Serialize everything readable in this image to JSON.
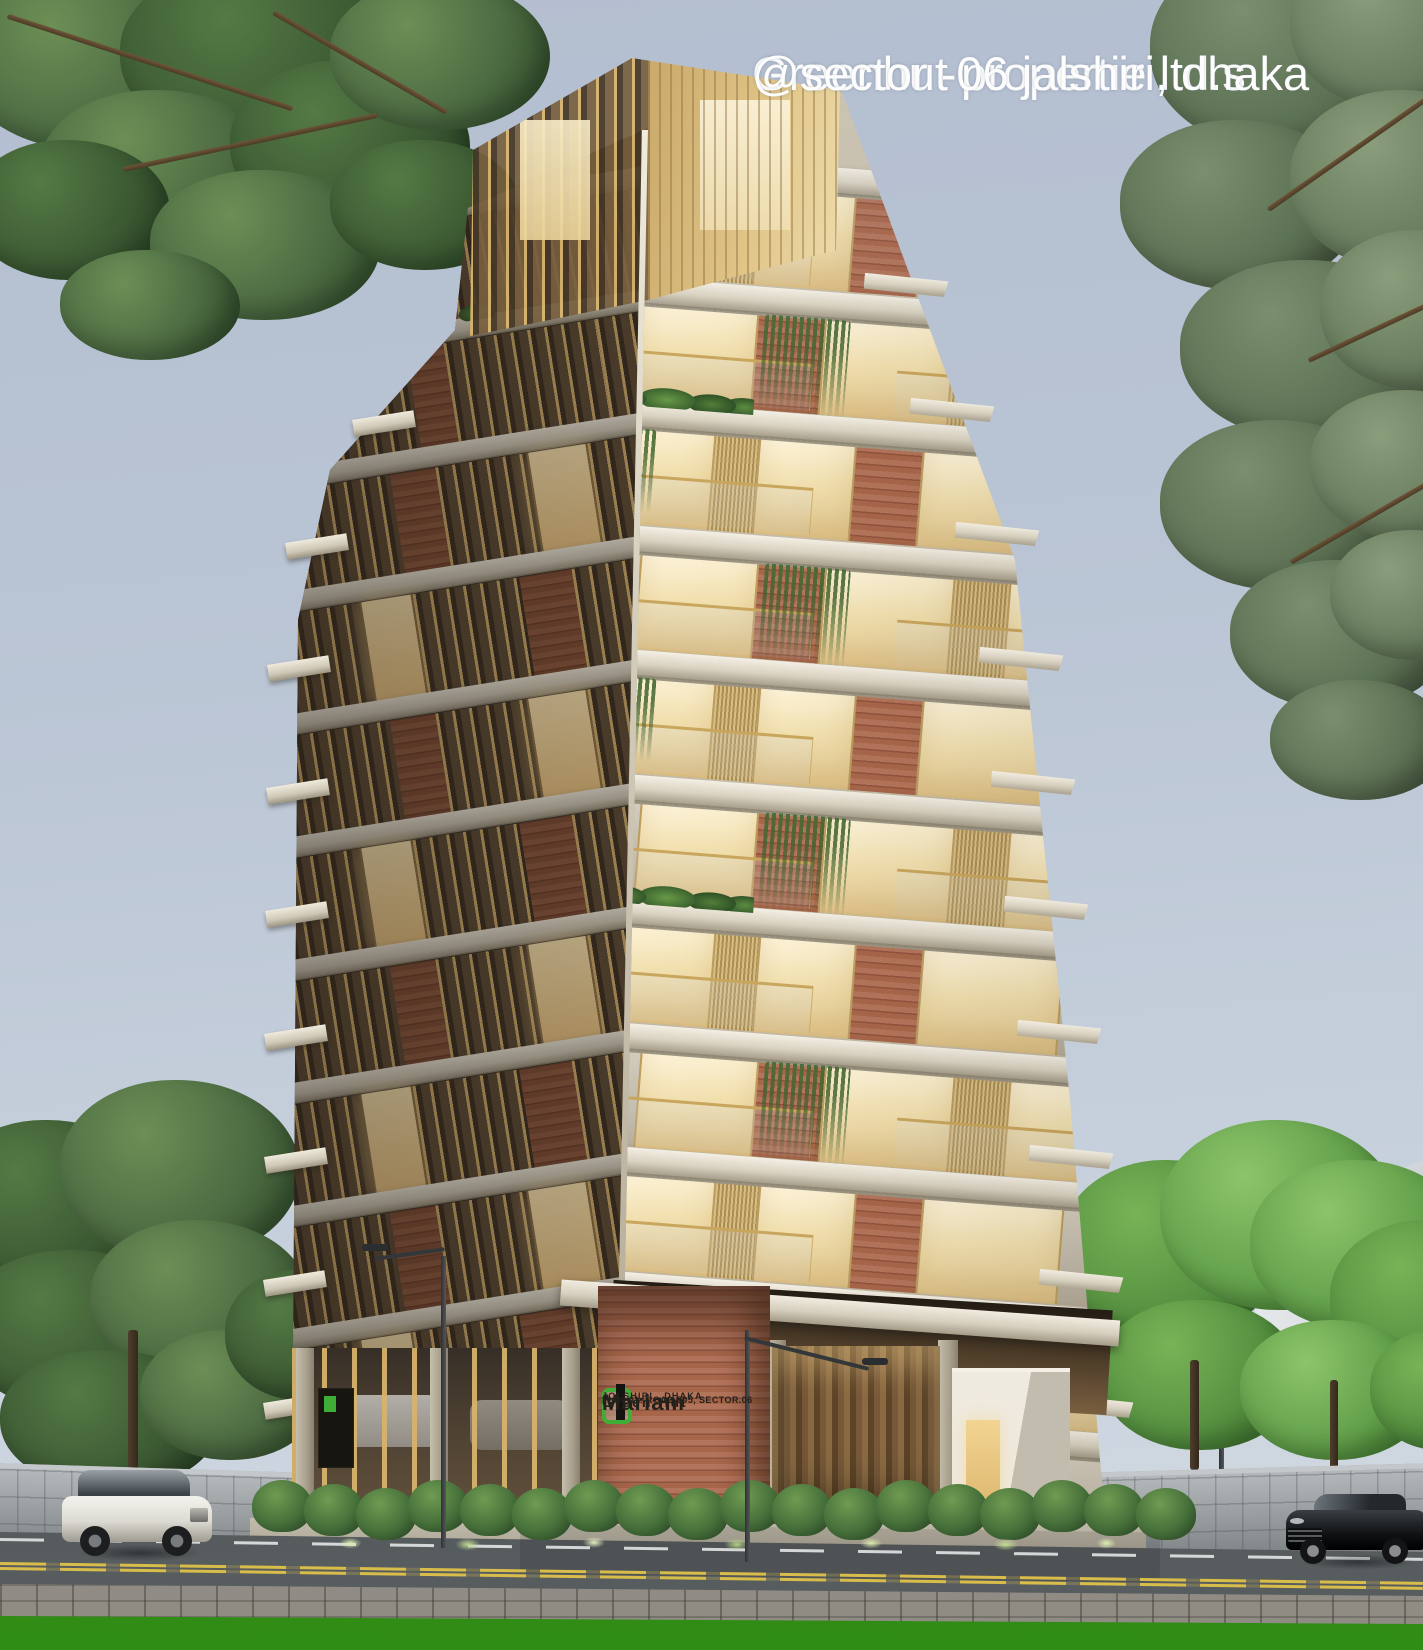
{
  "overlay": {
    "line1": "Greenhut propertie ltd.s",
    "line2": "@sector -06 jalshiri, dhaka"
  },
  "signage": {
    "logo_icon": "greenhut-logo",
    "brand_top": "Green Hut",
    "project_name": "Mariam",
    "address_line": "Plot# 01: ROAD.505, SECTOR.06",
    "city_line": "JOLSHIRI . DHAKA"
  },
  "palette": {
    "sky": "#b9c4d4",
    "concrete_slab": "#ded7c8",
    "warm_window": "#f4e4b6",
    "gold_louver": "#c8a55e",
    "brick": "#a8674a",
    "tree_green": "#4c6b42",
    "lawn_green": "#46a41f",
    "road_gray": "#54595c",
    "boundary_wall": "#9ca2a5",
    "logo_green": "#3fae36",
    "caption_white": "#fdfdfd",
    "sign_text": "#24211c"
  }
}
